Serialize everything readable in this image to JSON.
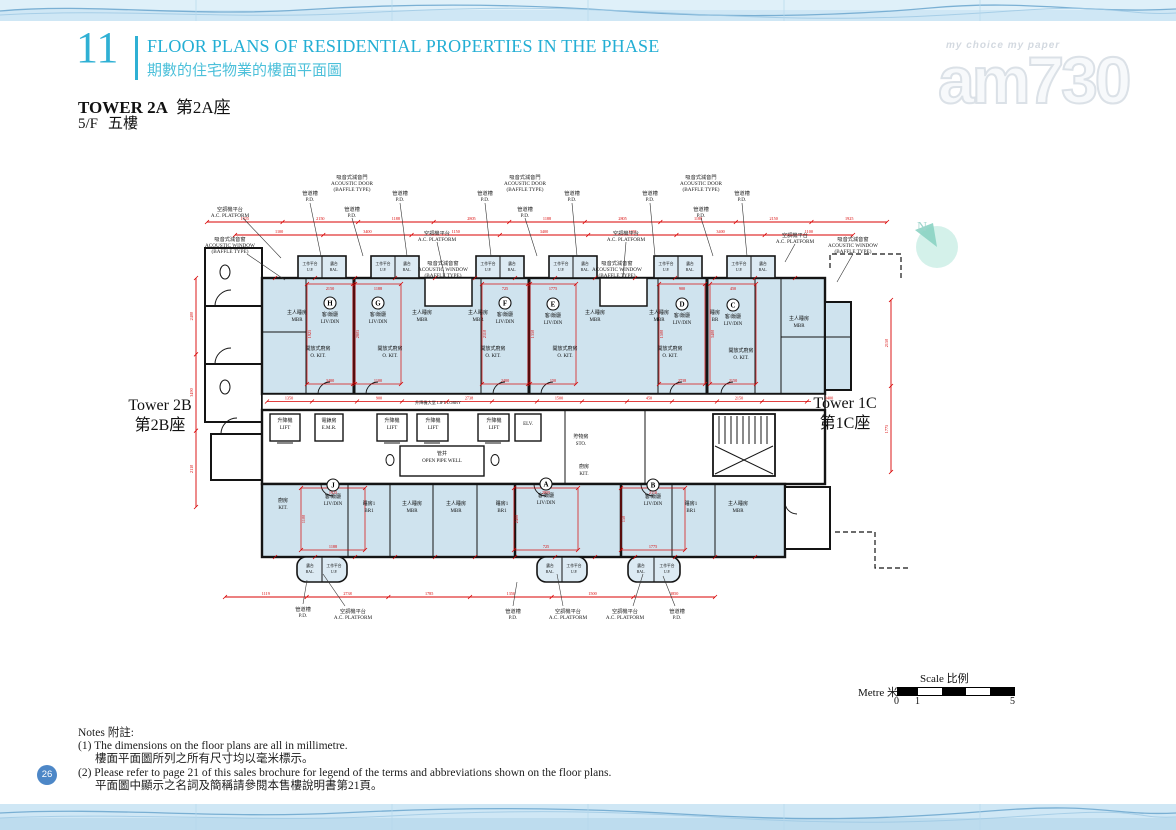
{
  "page_number": "26",
  "header": {
    "section_number": "11",
    "title_en": "FLOOR PLANS OF RESIDENTIAL PROPERTIES IN THE PHASE",
    "title_zh": "期數的住宅物業的樓面平面圖",
    "tower_en": "TOWER 2A",
    "tower_zh": "第2A座",
    "floor_en": "5/F",
    "floor_zh": "五樓"
  },
  "watermark": {
    "tagline": "my choice   my paper",
    "logo": "am730"
  },
  "north": {
    "label": "N"
  },
  "towers": {
    "left_en": "Tower 2B",
    "left_zh": "第2B座",
    "right_en": "Tower 1C",
    "right_zh": "第1C座"
  },
  "scalebar": {
    "label_scale": "Scale 比例",
    "label_metre": "Metre 米",
    "tick0": "0",
    "tick1": "1",
    "tick5": "5"
  },
  "notes": {
    "heading": "Notes 附註:",
    "items": [
      {
        "en": "(1) The dimensions on the floor plans are all in millimetre.",
        "zh": "樓面平面圖所列之所有尺寸均以毫米標示。"
      },
      {
        "en": "(2) Please refer to page 21 of this sales brochure for legend of the terms and abbreviations shown on the floor plans.",
        "zh": "平面圖中顯示之名詞及簡稱請參閱本售樓說明書第21頁。"
      }
    ]
  },
  "plan": {
    "unit_caption": [
      "客/飯廳",
      "LIV/DIN"
    ],
    "units_top": [
      {
        "letter": "H",
        "x": 145,
        "y": 140
      },
      {
        "letter": "G",
        "x": 193,
        "y": 140
      },
      {
        "letter": "F",
        "x": 320,
        "y": 140
      },
      {
        "letter": "E",
        "x": 368,
        "y": 141
      },
      {
        "letter": "D",
        "x": 497,
        "y": 141
      },
      {
        "letter": "C",
        "x": 548,
        "y": 142
      }
    ],
    "units_bottom": [
      {
        "letter": "J",
        "x": 148,
        "y": 322
      },
      {
        "letter": "A",
        "x": 361,
        "y": 321
      },
      {
        "letter": "B",
        "x": 468,
        "y": 322
      }
    ],
    "rooms": [
      {
        "zh": "主人睡房",
        "en": "MBR",
        "x": 112,
        "y": 142
      },
      {
        "zh": "主人睡房",
        "en": "MBR",
        "x": 237,
        "y": 142
      },
      {
        "zh": "主人睡房",
        "en": "MBR",
        "x": 293,
        "y": 142
      },
      {
        "zh": "主人睡房",
        "en": "MBR",
        "x": 410,
        "y": 142
      },
      {
        "zh": "主人睡房",
        "en": "MBR",
        "x": 474,
        "y": 142
      },
      {
        "zh": "睡房",
        "en": "BR",
        "x": 530,
        "y": 142
      },
      {
        "zh": "主人睡房",
        "en": "MBR",
        "x": 614,
        "y": 148
      },
      {
        "zh": "開放式廚房",
        "en": "O. KIT.",
        "x": 133,
        "y": 178
      },
      {
        "zh": "開放式廚房",
        "en": "O. KIT.",
        "x": 205,
        "y": 178
      },
      {
        "zh": "開放式廚房",
        "en": "O. KIT.",
        "x": 308,
        "y": 178
      },
      {
        "zh": "開放式廚房",
        "en": "O. KIT.",
        "x": 380,
        "y": 178
      },
      {
        "zh": "開放式廚房",
        "en": "O. KIT.",
        "x": 485,
        "y": 178
      },
      {
        "zh": "開放式廚房",
        "en": "O. KIT.",
        "x": 556,
        "y": 180
      },
      {
        "zh": "升降機",
        "en": "LIFT",
        "x": 100,
        "y": 250
      },
      {
        "zh": "電錶房",
        "en": "E.M.R.",
        "x": 144,
        "y": 250
      },
      {
        "zh": "升降機",
        "en": "LIFT",
        "x": 207,
        "y": 250
      },
      {
        "zh": "升降機",
        "en": "LIFT",
        "x": 248,
        "y": 250
      },
      {
        "zh": "升降機",
        "en": "LIFT",
        "x": 309,
        "y": 250
      },
      {
        "en": "ELV.",
        "x": 343,
        "y": 253
      },
      {
        "zh": "管井",
        "en": "OPEN PIPE WELL",
        "x": 257,
        "y": 283
      },
      {
        "zh": "貯物房",
        "en": "STO.",
        "x": 396,
        "y": 266
      },
      {
        "zh": "廚房",
        "en": "KIT.",
        "x": 98,
        "y": 330
      },
      {
        "zh": "睡房1",
        "en": "BR1",
        "x": 184,
        "y": 333
      },
      {
        "zh": "主人睡房",
        "en": "MBR",
        "x": 227,
        "y": 333
      },
      {
        "zh": "主人睡房",
        "en": "MBR",
        "x": 271,
        "y": 333
      },
      {
        "zh": "睡房1",
        "en": "BR1",
        "x": 317,
        "y": 333
      },
      {
        "zh": "廚房",
        "en": "KIT.",
        "x": 399,
        "y": 296
      },
      {
        "zh": "睡房1",
        "en": "BR1",
        "x": 506,
        "y": 333
      },
      {
        "zh": "主人睡房",
        "en": "MBR",
        "x": 553,
        "y": 333
      },
      {
        "zh": "升降機大堂 LIFT LOBBY",
        "x": 253,
        "y": 232,
        "inline": true
      }
    ],
    "balcony_cells": {
      "up": [
        "工作平台",
        "U.P."
      ],
      "bal": [
        "露台",
        "BAL."
      ]
    },
    "annotations": [
      {
        "lines": [
          "管道槽",
          "P.D."
        ],
        "x": 125,
        "y": 18,
        "lead": [
          125,
          31,
          136,
          84
        ]
      },
      {
        "lines": [
          "吸音式減音門",
          "ACOUSTIC DOOR",
          "(BAFFLE TYPE)"
        ],
        "x": 167,
        "y": 2
      },
      {
        "lines": [
          "管道槽",
          "P.D."
        ],
        "x": 167,
        "y": 34,
        "lead": [
          167,
          46,
          178,
          84
        ]
      },
      {
        "lines": [
          "管道槽",
          "P.D."
        ],
        "x": 215,
        "y": 18,
        "lead": [
          215,
          31,
          222,
          84
        ]
      },
      {
        "lines": [
          "管道槽",
          "P.D."
        ],
        "x": 300,
        "y": 18,
        "lead": [
          300,
          31,
          306,
          84
        ]
      },
      {
        "lines": [
          "吸音式減音門",
          "ACOUSTIC DOOR",
          "(BAFFLE TYPE)"
        ],
        "x": 340,
        "y": 2
      },
      {
        "lines": [
          "管道槽",
          "P.D."
        ],
        "x": 340,
        "y": 34,
        "lead": [
          340,
          46,
          352,
          84
        ]
      },
      {
        "lines": [
          "管道槽",
          "P.D."
        ],
        "x": 387,
        "y": 18,
        "lead": [
          387,
          31,
          392,
          84
        ]
      },
      {
        "lines": [
          "管道槽",
          "P.D."
        ],
        "x": 465,
        "y": 18,
        "lead": [
          465,
          31,
          470,
          84
        ]
      },
      {
        "lines": [
          "吸音式減音門",
          "ACOUSTIC DOOR",
          "(BAFFLE TYPE)"
        ],
        "x": 516,
        "y": 2
      },
      {
        "lines": [
          "管道槽",
          "P.D."
        ],
        "x": 516,
        "y": 34,
        "lead": [
          516,
          46,
          528,
          84
        ]
      },
      {
        "lines": [
          "管道槽",
          "P.D."
        ],
        "x": 557,
        "y": 18,
        "lead": [
          557,
          31,
          562,
          84
        ]
      },
      {
        "lines": [
          "空調機平台",
          "A.C. PLATFORM"
        ],
        "x": 45,
        "y": 34,
        "lead": [
          58,
          46,
          96,
          86
        ]
      },
      {
        "lines": [
          "吸音式減音窗",
          "ACOUSTIC WINDOW",
          "(BAFFLE TYPE)"
        ],
        "x": 45,
        "y": 64,
        "lead": [
          62,
          82,
          100,
          108
        ]
      },
      {
        "lines": [
          "空調機平台",
          "A.C. PLATFORM"
        ],
        "x": 252,
        "y": 58,
        "lead": [
          252,
          70,
          260,
          106
        ]
      },
      {
        "lines": [
          "吸音式減音窗",
          "ACOUSTIC WINDOW",
          "(BAFFLE TYPE)"
        ],
        "x": 258,
        "y": 88
      },
      {
        "lines": [
          "空調機平台",
          "A.C. PLATFORM"
        ],
        "x": 441,
        "y": 58,
        "lead": [
          441,
          70,
          438,
          106
        ]
      },
      {
        "lines": [
          "吸音式減音窗",
          "ACOUSTIC WINDOW",
          "(BAFFLE TYPE)"
        ],
        "x": 432,
        "y": 88
      },
      {
        "lines": [
          "空調機平台",
          "A.C. PLATFORM"
        ],
        "x": 610,
        "y": 60,
        "lead": [
          610,
          72,
          600,
          90
        ]
      },
      {
        "lines": [
          "吸音式減音窗",
          "ACOUSTIC WINDOW",
          "(BAFFLE TYPE)"
        ],
        "x": 668,
        "y": 64,
        "lead": [
          668,
          82,
          652,
          110
        ]
      },
      {
        "lines": [
          "管道槽",
          "P.D."
        ],
        "x": 118,
        "y": 434,
        "lead": [
          118,
          432,
          122,
          408
        ]
      },
      {
        "lines": [
          "空調機平台",
          "A.C. PLATFORM"
        ],
        "x": 168,
        "y": 436,
        "lead": [
          160,
          434,
          138,
          402
        ]
      },
      {
        "lines": [
          "管道槽",
          "P.D."
        ],
        "x": 328,
        "y": 436,
        "lead": [
          328,
          434,
          332,
          410
        ]
      },
      {
        "lines": [
          "空調機平台",
          "A.C. PLATFORM"
        ],
        "x": 383,
        "y": 436,
        "lead": [
          378,
          434,
          372,
          402
        ]
      },
      {
        "lines": [
          "空調機平台",
          "A.C. PLATFORM"
        ],
        "x": 440,
        "y": 436,
        "lead": [
          448,
          434,
          458,
          402
        ]
      },
      {
        "lines": [
          "管道槽",
          "P.D."
        ],
        "x": 492,
        "y": 436,
        "lead": [
          490,
          434,
          478,
          404
        ]
      }
    ],
    "dims_h": [
      {
        "y": 50,
        "x1": 22,
        "x2": 702,
        "labels": [
          "1925",
          "2150",
          "1188",
          "2805",
          "1188",
          "2805",
          "1188",
          "2150",
          "1925"
        ]
      },
      {
        "y": 63,
        "x1": 50,
        "x2": 668,
        "labels": [
          "1100",
          "3400",
          "1150",
          "3400",
          "1150",
          "3400",
          "1100"
        ]
      },
      {
        "y": 425,
        "x1": 40,
        "x2": 530,
        "labels": [
          "1119",
          "2738",
          "1785",
          "1350",
          "1500",
          "3850"
        ]
      }
    ],
    "dims_v": [
      {
        "x": 11,
        "y1": 106,
        "y2": 335,
        "labels": [
          "2400",
          "3490",
          "2110"
        ]
      },
      {
        "x": 706,
        "y1": 128,
        "y2": 300,
        "labels": [
          "2150",
          "1775"
        ]
      }
    ],
    "dim_values": [
      "2150",
      "3400",
      "1925",
      "1188",
      "1100",
      "2805",
      "725",
      "2400",
      "2110",
      "1775",
      "150",
      "1350",
      "900",
      "2738",
      "1500",
      "450"
    ]
  }
}
